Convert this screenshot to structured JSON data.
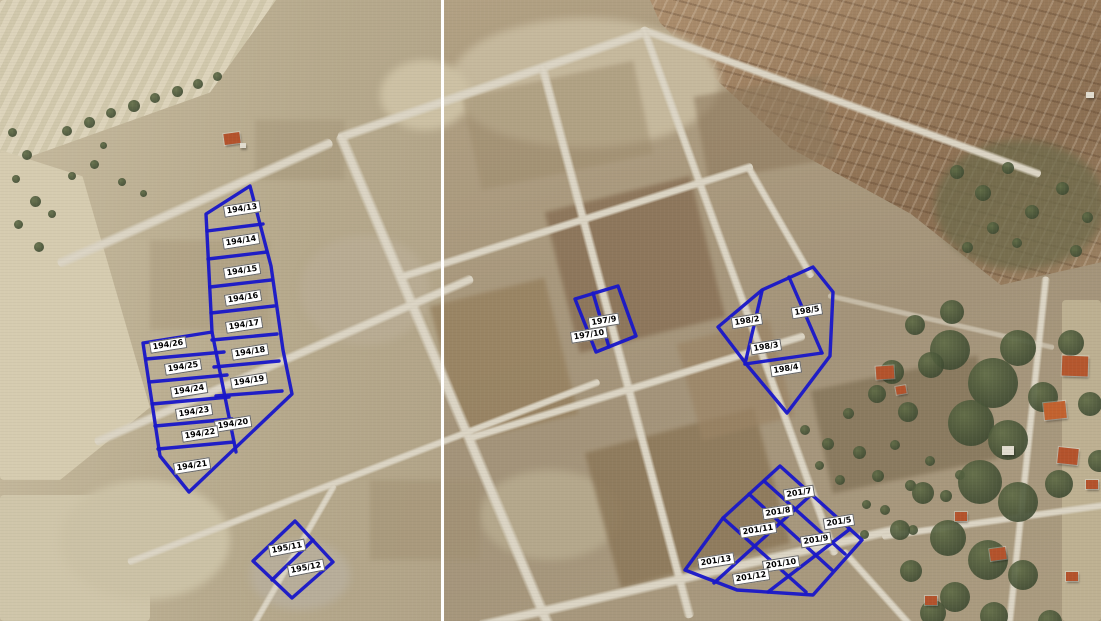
{
  "map": {
    "kind": "aerial-orthophoto-with-cadastral-parcel-overlay",
    "overlay": {
      "boundary_color": "#1a18c8",
      "label_background": "#ffffff",
      "label_text_color": "#000000"
    },
    "blocks": [
      {
        "block": "194",
        "parcel_count": 14
      },
      {
        "block": "195",
        "parcel_count": 2
      },
      {
        "block": "197",
        "parcel_count": 2
      },
      {
        "block": "198",
        "parcel_count": 4
      },
      {
        "block": "201",
        "parcel_count": 8
      }
    ],
    "parcels": [
      {
        "label": "194/13"
      },
      {
        "label": "194/14"
      },
      {
        "label": "194/15"
      },
      {
        "label": "194/16"
      },
      {
        "label": "194/17"
      },
      {
        "label": "194/18"
      },
      {
        "label": "194/19"
      },
      {
        "label": "194/20"
      },
      {
        "label": "194/21"
      },
      {
        "label": "194/22"
      },
      {
        "label": "194/23"
      },
      {
        "label": "194/24"
      },
      {
        "label": "194/25"
      },
      {
        "label": "194/26"
      },
      {
        "label": "195/11"
      },
      {
        "label": "195/12"
      },
      {
        "label": "197/9"
      },
      {
        "label": "197/10"
      },
      {
        "label": "198/2"
      },
      {
        "label": "198/3"
      },
      {
        "label": "198/4"
      },
      {
        "label": "198/5"
      },
      {
        "label": "201/5"
      },
      {
        "label": "201/7"
      },
      {
        "label": "201/8"
      },
      {
        "label": "201/9"
      },
      {
        "label": "201/10"
      },
      {
        "label": "201/11"
      },
      {
        "label": "201/12"
      },
      {
        "label": "201/13"
      }
    ]
  }
}
